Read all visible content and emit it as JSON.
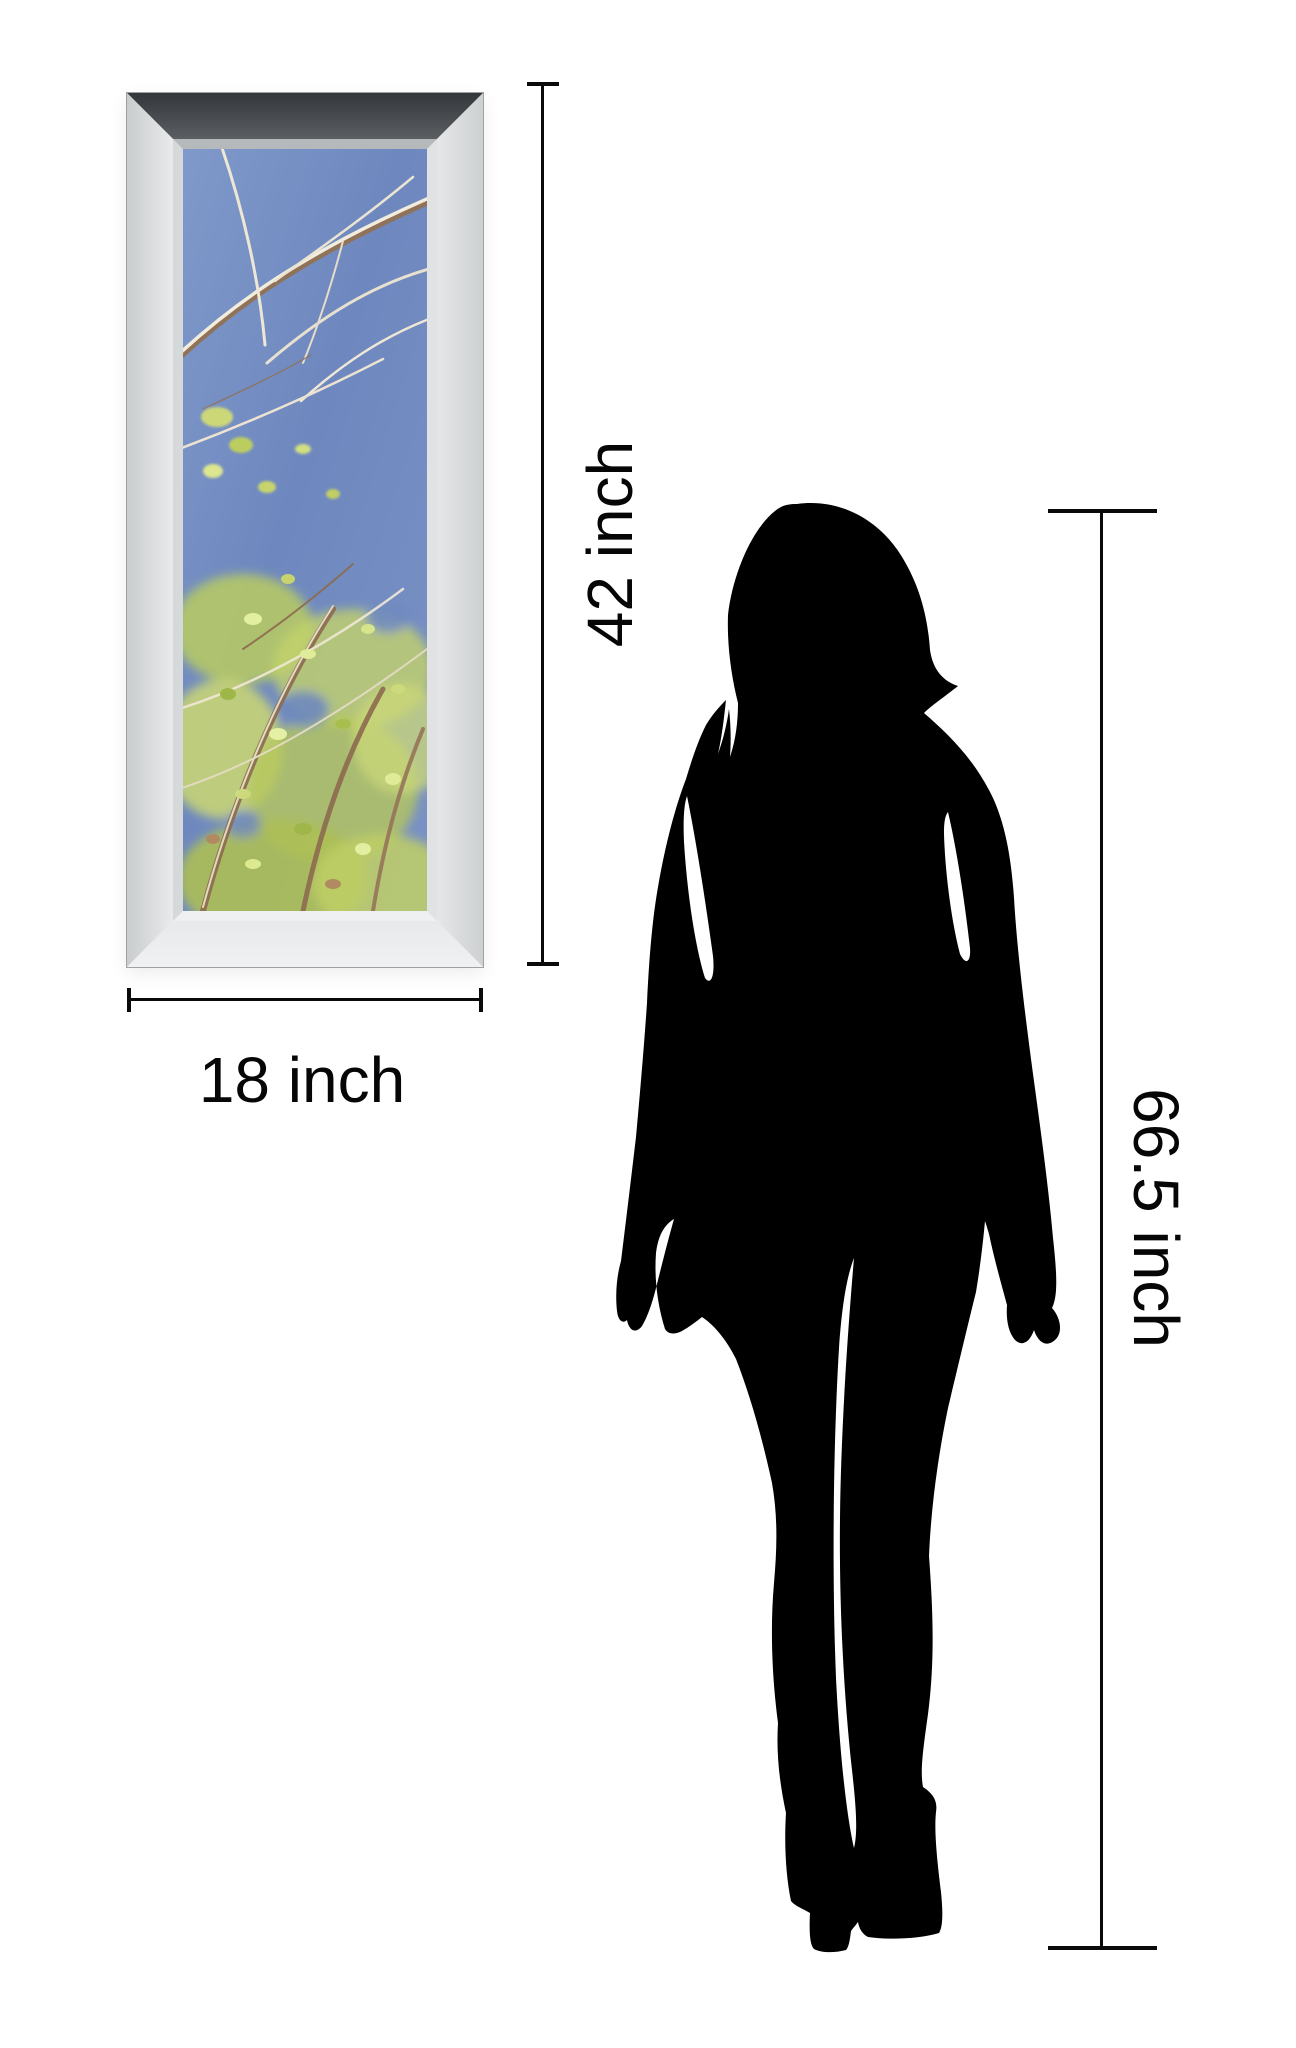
{
  "illustration": {
    "type": "product size comparison diagram",
    "background": "#ffffff"
  },
  "artwork_frame": {
    "style": "mirrored beveled frame",
    "art_description": "spring tree branches with yellow-green leaves against a blue sky",
    "colors": {
      "sky": "#6e88bf",
      "foliage": "#c0cf66",
      "branch": "#8d6b4f",
      "frame_face": "#eef0f0",
      "frame_top": "#7d8184"
    }
  },
  "dimensions": {
    "art_height_label": "42 inch",
    "art_width_label": "18 inch",
    "person_height_label": "66.5 inch",
    "line_color": "#0a0a0a"
  },
  "figure": {
    "description": "standing woman silhouette, rear view, long hair, high heels",
    "color": "#000000"
  }
}
